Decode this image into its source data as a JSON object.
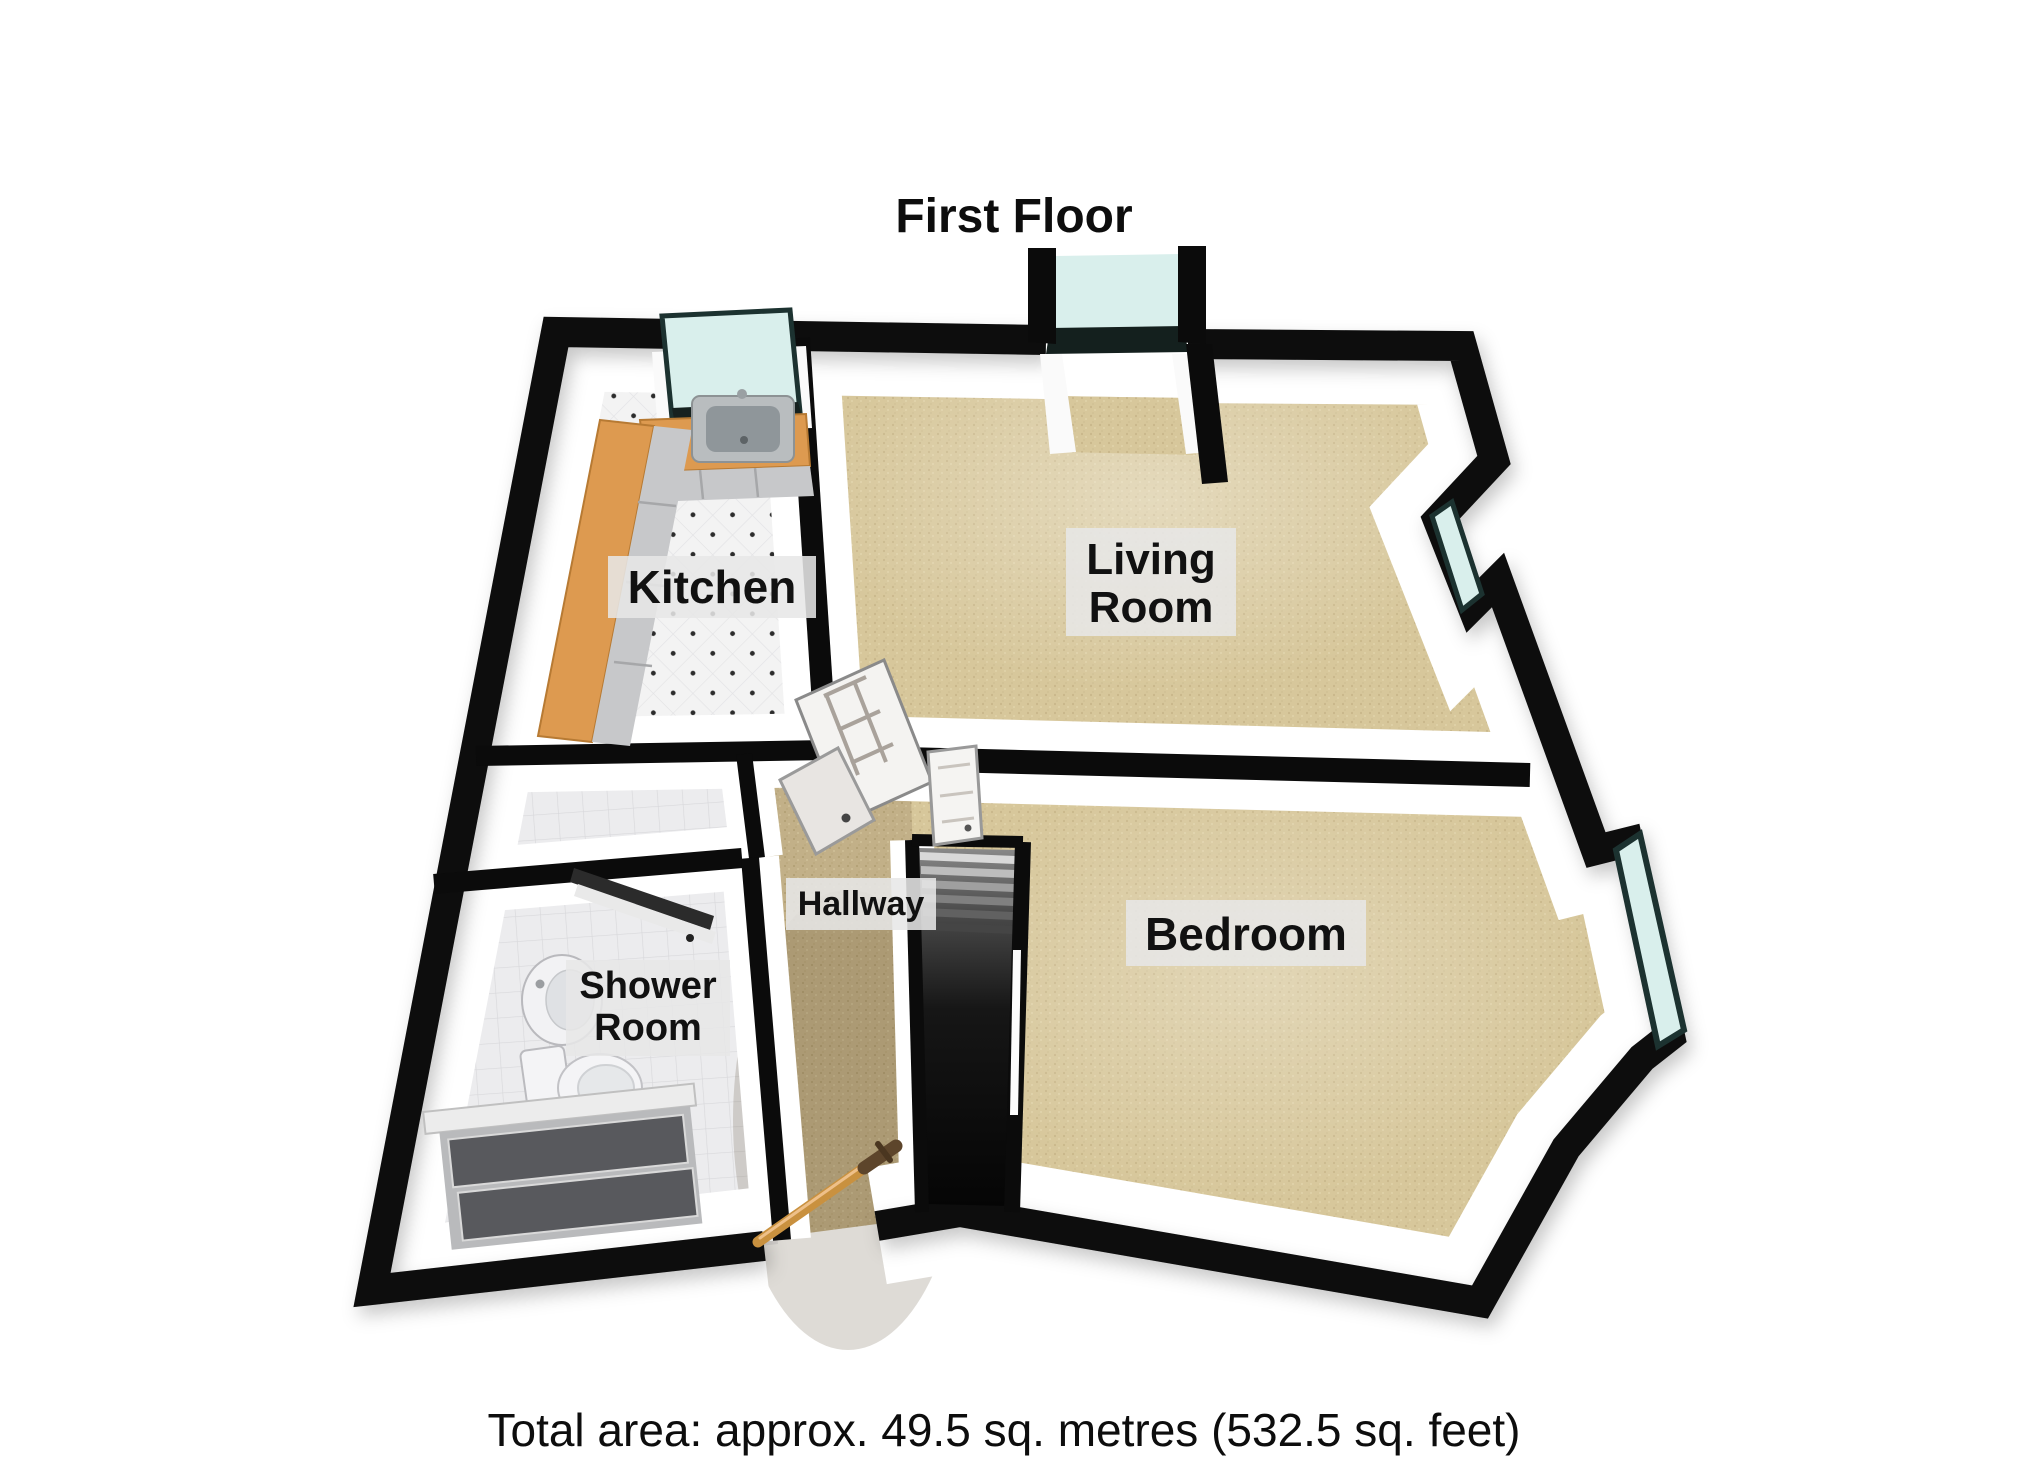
{
  "title": "First Floor",
  "footer": "Total area: approx. 49.5 sq. metres (532.5 sq. feet)",
  "total_area": {
    "sq_metres": "49.5",
    "sq_feet": "532.5"
  },
  "rooms": {
    "kitchen": {
      "label": "Kitchen"
    },
    "living_room": {
      "line1": "Living",
      "line2": "Room"
    },
    "hallway": {
      "label": "Hallway"
    },
    "shower_room": {
      "line1": "Shower",
      "line2": "Room"
    },
    "bedroom": {
      "label": "Bedroom"
    }
  },
  "palette": {
    "background": "#ffffff",
    "wall": "#0b0b0b",
    "carpet": "#d8c89c",
    "hall_carpet": "#c4b189",
    "tile_floor": "#ececee",
    "kitchen_floor": "#f3f3f3",
    "window_glass": "#d9efec",
    "window_frame": "#1c3230",
    "kitchen_counter": "#dd9a50",
    "handrail_wood": "#c9913f",
    "label_background": "#e7e7e7",
    "label_text": "#111111"
  }
}
